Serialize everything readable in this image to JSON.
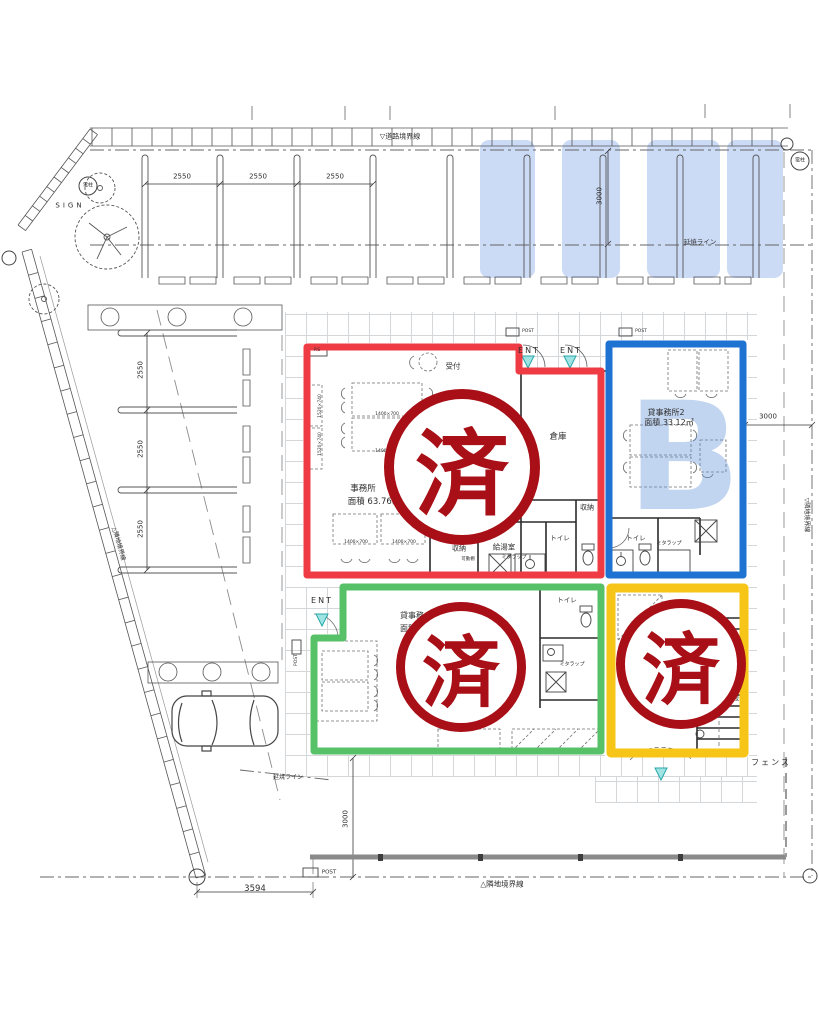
{
  "labels": {
    "road_boundary": "▽道路境界線",
    "neighbor_boundary": "△隣地境界線",
    "neighbor_boundary_left": "△隣地境界線",
    "neighbor_boundary_right": "▽隣地境界線",
    "fire_spread_line": "延焼ライン",
    "fence": "フェンス",
    "sign": "SIGN",
    "utility_pole": "電柱",
    "post": "POST",
    "entrance": "ENT"
  },
  "dimensions": {
    "parking_top": [
      "2550",
      "2550",
      "2550"
    ],
    "parking_left": [
      "2550",
      "2550",
      "2550"
    ],
    "parking_depth": "3000",
    "right_offset": "3000",
    "bottom_offset": "3000",
    "frontage": "3594"
  },
  "stamp": {
    "text": "済",
    "color": "#a80f16"
  },
  "units": {
    "office": {
      "name": "事務所",
      "area": "面積 63.76㎡",
      "outline_color": "#ef3b44"
    },
    "rental2": {
      "name": "貸事務所2",
      "area": "面積 33.12㎡",
      "watermark": "B",
      "outline_color": "#1e72d2"
    },
    "rental1": {
      "name": "貸事務",
      "area": "面積",
      "outline_color": "#57c167"
    },
    "stair_unit": {
      "stair": "段",
      "outline_color": "#f6c517"
    }
  },
  "rooms": {
    "reception": "受付",
    "warehouse": "倉庫",
    "storage": "収納",
    "kitchenette": "給湯室",
    "toilet": "トイレ",
    "shelf": "可動棚",
    "trap": "ミタラップ",
    "ps": "P.S"
  },
  "furniture": {
    "table_dim": "1400×700",
    "cabinet_dim": "1520×740"
  }
}
